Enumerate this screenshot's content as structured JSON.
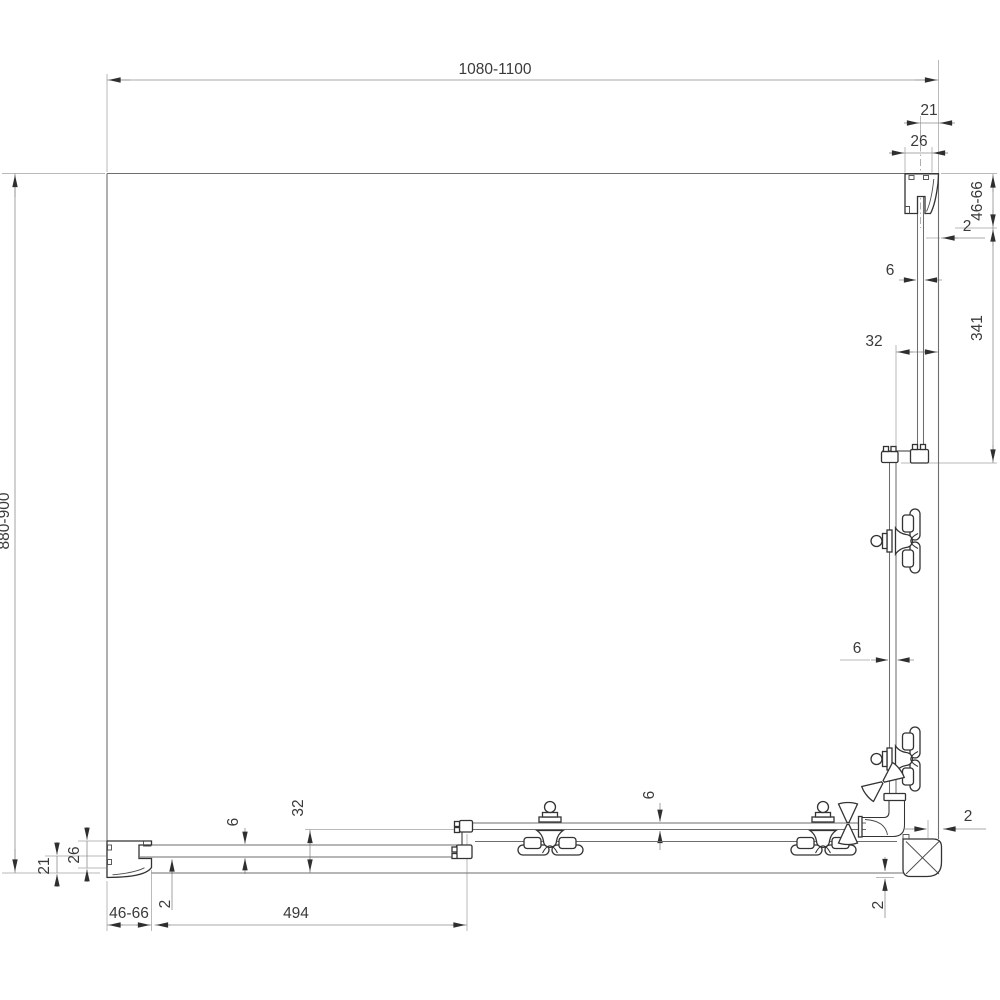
{
  "drawing": {
    "type": "technical-dimension-drawing",
    "subject": "corner shower enclosure with sliding doors — sectional plan view with profile, glass and roller details"
  },
  "dimensions": {
    "top_width": "1080-1100",
    "left_height": "880-900",
    "right_wall_profile": {
      "offset": "21",
      "width": "26",
      "adjust": "46-66",
      "gap": "2",
      "glass": "6",
      "door_offset": "32",
      "fixed_glass_len": "341"
    },
    "right_door": {
      "glass": "6"
    },
    "corner": {
      "gap_h": "2",
      "gap_v": "2"
    },
    "bottom_wall_profile": {
      "offset": "21",
      "width": "26",
      "adjust": "46-66",
      "gap": "2",
      "glass": "6",
      "door_offset": "32",
      "fixed_glass_len": "494"
    },
    "bottom_door": {
      "glass": "6"
    }
  },
  "colors": {
    "background": "#ffffff",
    "drawing_line": "#6e6e6e",
    "hardware_line": "#333333",
    "dimension_line": "#8c8c8c",
    "text": "#3a3a3a"
  }
}
